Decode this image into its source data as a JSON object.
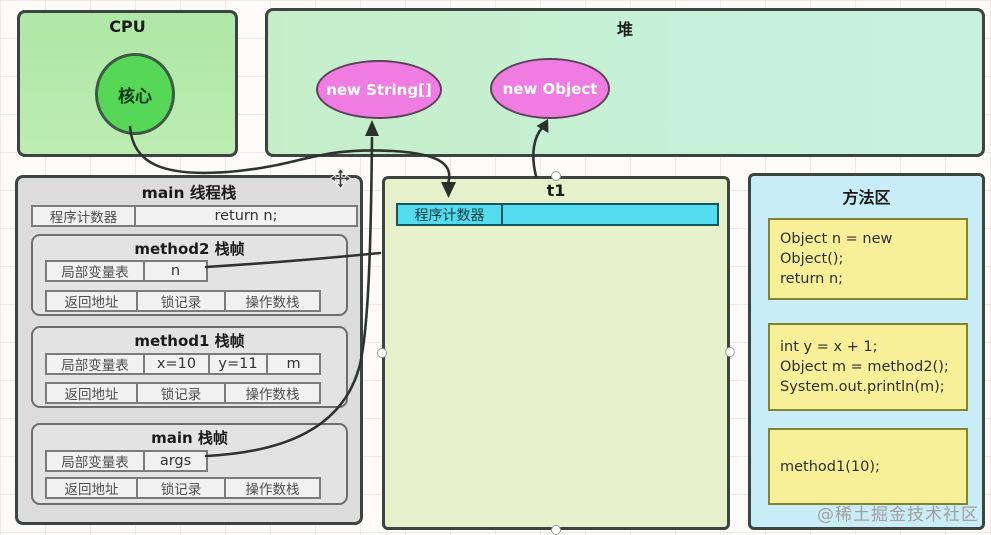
{
  "cpu": {
    "title": "CPU",
    "core_label": "核心"
  },
  "heap": {
    "title": "堆",
    "objects": [
      {
        "label": "new String[]"
      },
      {
        "label": "new Object"
      }
    ]
  },
  "main_stack": {
    "title": "main 线程栈",
    "pc": {
      "label": "程序计数器",
      "value": "return n;"
    },
    "frames": [
      {
        "title": "method2 栈帧",
        "var_cells": [
          "局部变量表",
          "n"
        ],
        "bottom_cells": [
          "返回地址",
          "锁记录",
          "操作数栈"
        ]
      },
      {
        "title": "method1 栈帧",
        "var_cells": [
          "局部变量表",
          "x=10",
          "y=11",
          "m"
        ],
        "bottom_cells": [
          "返回地址",
          "锁记录",
          "操作数栈"
        ]
      },
      {
        "title": "main 栈帧",
        "var_cells": [
          "局部变量表",
          "args"
        ],
        "bottom_cells": [
          "返回地址",
          "锁记录",
          "操作数栈"
        ]
      }
    ]
  },
  "t1_stack": {
    "title": "t1",
    "pc_label": "程序计数器",
    "pc_value": ""
  },
  "method_area": {
    "title": "方法区",
    "code_blocks": [
      "Object n = new Object();\nreturn n;",
      "int y = x + 1;\nObject m = method2();\nSystem.out.println(m);",
      "method1(10);"
    ]
  },
  "watermark": "@稀土掘金技术社区",
  "colors": {
    "cpu_fill": "#b4e8ab",
    "heap_fill_left": "#c5eec8",
    "heap_fill_right": "#c7f2e2",
    "core_fill": "#57d757",
    "heap_object_fill": "#ee7ce1",
    "stack_fill": "#dcdcdc",
    "t1_fill": "#e6f1cc",
    "t1_pc_row_fill": "#52dcee",
    "method_area_fill": "#c8edf6",
    "code_block_fill": "#f8f099",
    "arrow_color": "#2e3331",
    "border_dark": "#3d4341"
  }
}
